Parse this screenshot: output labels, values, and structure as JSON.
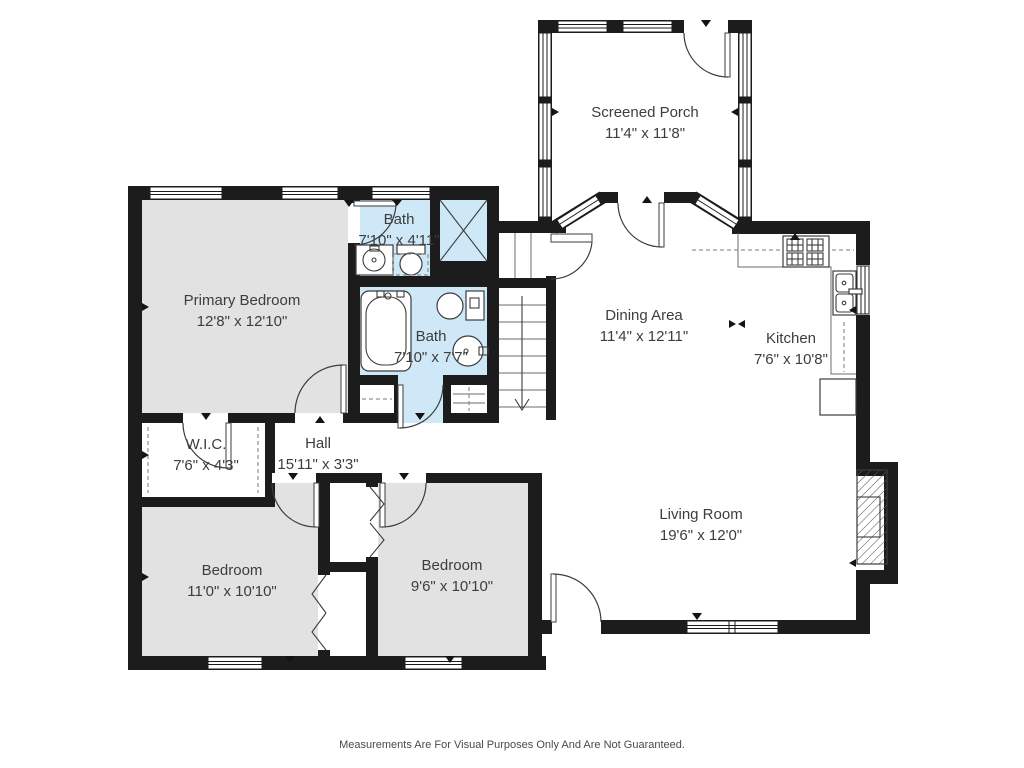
{
  "rooms": {
    "screened_porch": {
      "name": "Screened Porch",
      "dims": "11'4\" x 11'8\""
    },
    "primary_bedroom": {
      "name": "Primary Bedroom",
      "dims": "12'8\" x 12'10\""
    },
    "bath_upper": {
      "name": "Bath",
      "dims": "7'10\" x 4'11\""
    },
    "bath_lower": {
      "name": "Bath",
      "dims": "7'10\" x 7'7\""
    },
    "dining_area": {
      "name": "Dining Area",
      "dims": "11'4\" x 12'11\""
    },
    "kitchen": {
      "name": "Kitchen",
      "dims": "7'6\" x 10'8\""
    },
    "wic": {
      "name": "W.I.C.",
      "dims": "7'6\" x 4'3\""
    },
    "hall": {
      "name": "Hall",
      "dims": "15'11\" x 3'3\""
    },
    "bedroom_left": {
      "name": "Bedroom",
      "dims": "11'0\" x 10'10\""
    },
    "bedroom_right": {
      "name": "Bedroom",
      "dims": "9'6\" x 10'10\""
    },
    "living_room": {
      "name": "Living Room",
      "dims": "19'6\" x 12'0\""
    }
  },
  "footer": {
    "disclaimer": "Measurements Are For Visual Purposes Only And Are Not Guaranteed."
  },
  "colors": {
    "wall": "#1c1c1c",
    "bedroom_fill": "#e2e2e2",
    "bath_fill": "#cfe8f7",
    "line": "#3c3c3c",
    "text": "#3d3d3d"
  }
}
